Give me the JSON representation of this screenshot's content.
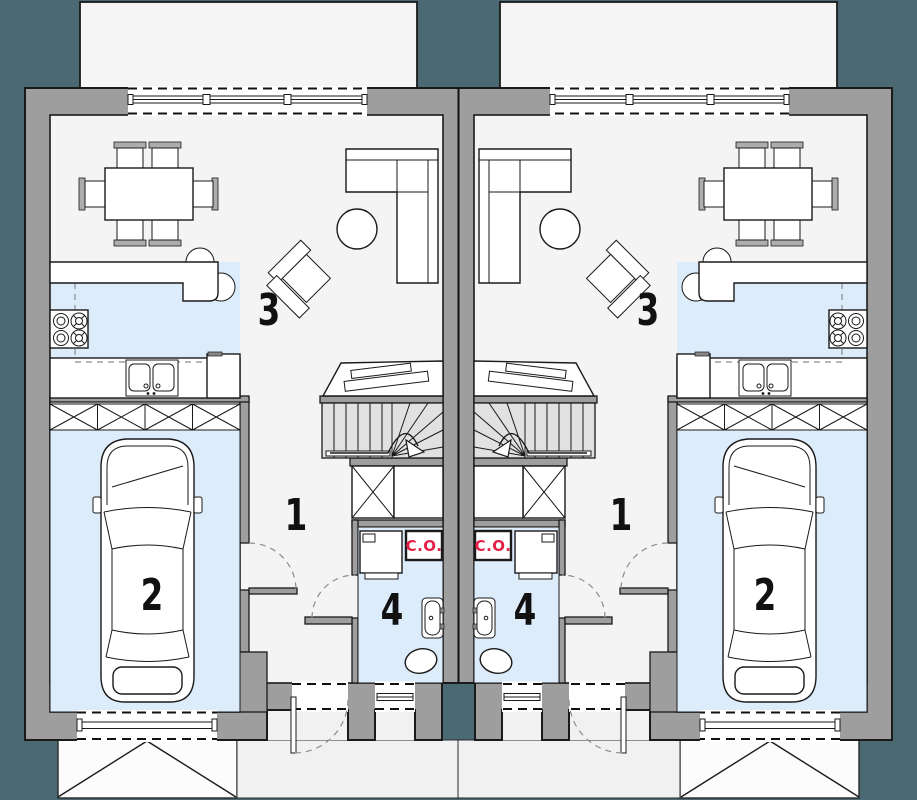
{
  "plan": {
    "type": "architectural-floor-plan",
    "description": "ground floor plan of a mirrored twin (semi-detached) house",
    "boiler_label": "C.O.",
    "rooms": [
      {
        "number": "1",
        "name": "hall"
      },
      {
        "number": "2",
        "name": "garage"
      },
      {
        "number": "3",
        "name": "living-room-with-kitchen"
      },
      {
        "number": "4",
        "name": "bathroom"
      }
    ],
    "units": [
      {
        "id": "unit-left"
      },
      {
        "id": "unit-right"
      }
    ],
    "colors": {
      "background": "#4B6973",
      "walls": "#9E9E9E",
      "floor": "#F4F4F4",
      "stairs": "#E1E1E1",
      "water_blue": "#DDECFA",
      "outline": "#1A1A1A",
      "boiler_red": "#E32147"
    }
  }
}
